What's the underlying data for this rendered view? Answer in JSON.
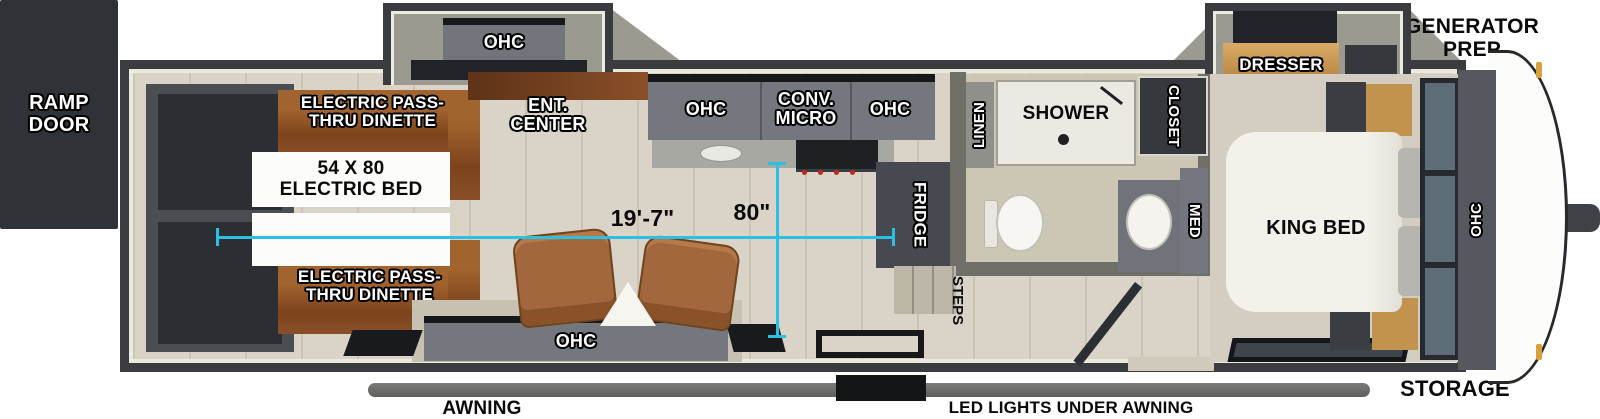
{
  "colors": {
    "accent_cyan": "#2bbfe2",
    "body_charcoal": "#3a3c40",
    "floor_beige": "#d9d4c7",
    "cabinet_gray": "#74777d",
    "wood_brown": "#8a4f28",
    "awning_gray": "#6a6a68",
    "bed_white": "#f3f1ea",
    "recliner_brown": "#a2673c"
  },
  "exterior": {
    "ramp_door": "RAMP DOOR",
    "generator_prep": "GENERATOR PREP",
    "storage": "STORAGE",
    "awning": "AWNING",
    "led_lights": "LED LIGHTS UNDER AWNING"
  },
  "dimensions": {
    "length": "19'-7\"",
    "width": "80\""
  },
  "garage": {
    "dinette_top": "ELECTRIC PASS-THRU DINETTE",
    "electric_bed": "54 X 80 ELECTRIC BED",
    "dinette_bottom": "ELECTRIC PASS-THRU DINETTE"
  },
  "living": {
    "slideout_ohc": "OHC",
    "ent_center": "ENT. CENTER",
    "rear_ohc": "OHC"
  },
  "kitchen": {
    "ohc_left": "OHC",
    "conv_micro": "CONV. MICRO",
    "ohc_right": "OHC",
    "fridge": "FRIDGE"
  },
  "bathroom": {
    "linen": "LINEN",
    "shower": "SHOWER",
    "closet": "CLOSET",
    "med": "MED",
    "steps": "STEPS"
  },
  "bedroom": {
    "dresser": "DRESSER",
    "king_bed": "KING BED",
    "front_ohc": "OHC"
  }
}
